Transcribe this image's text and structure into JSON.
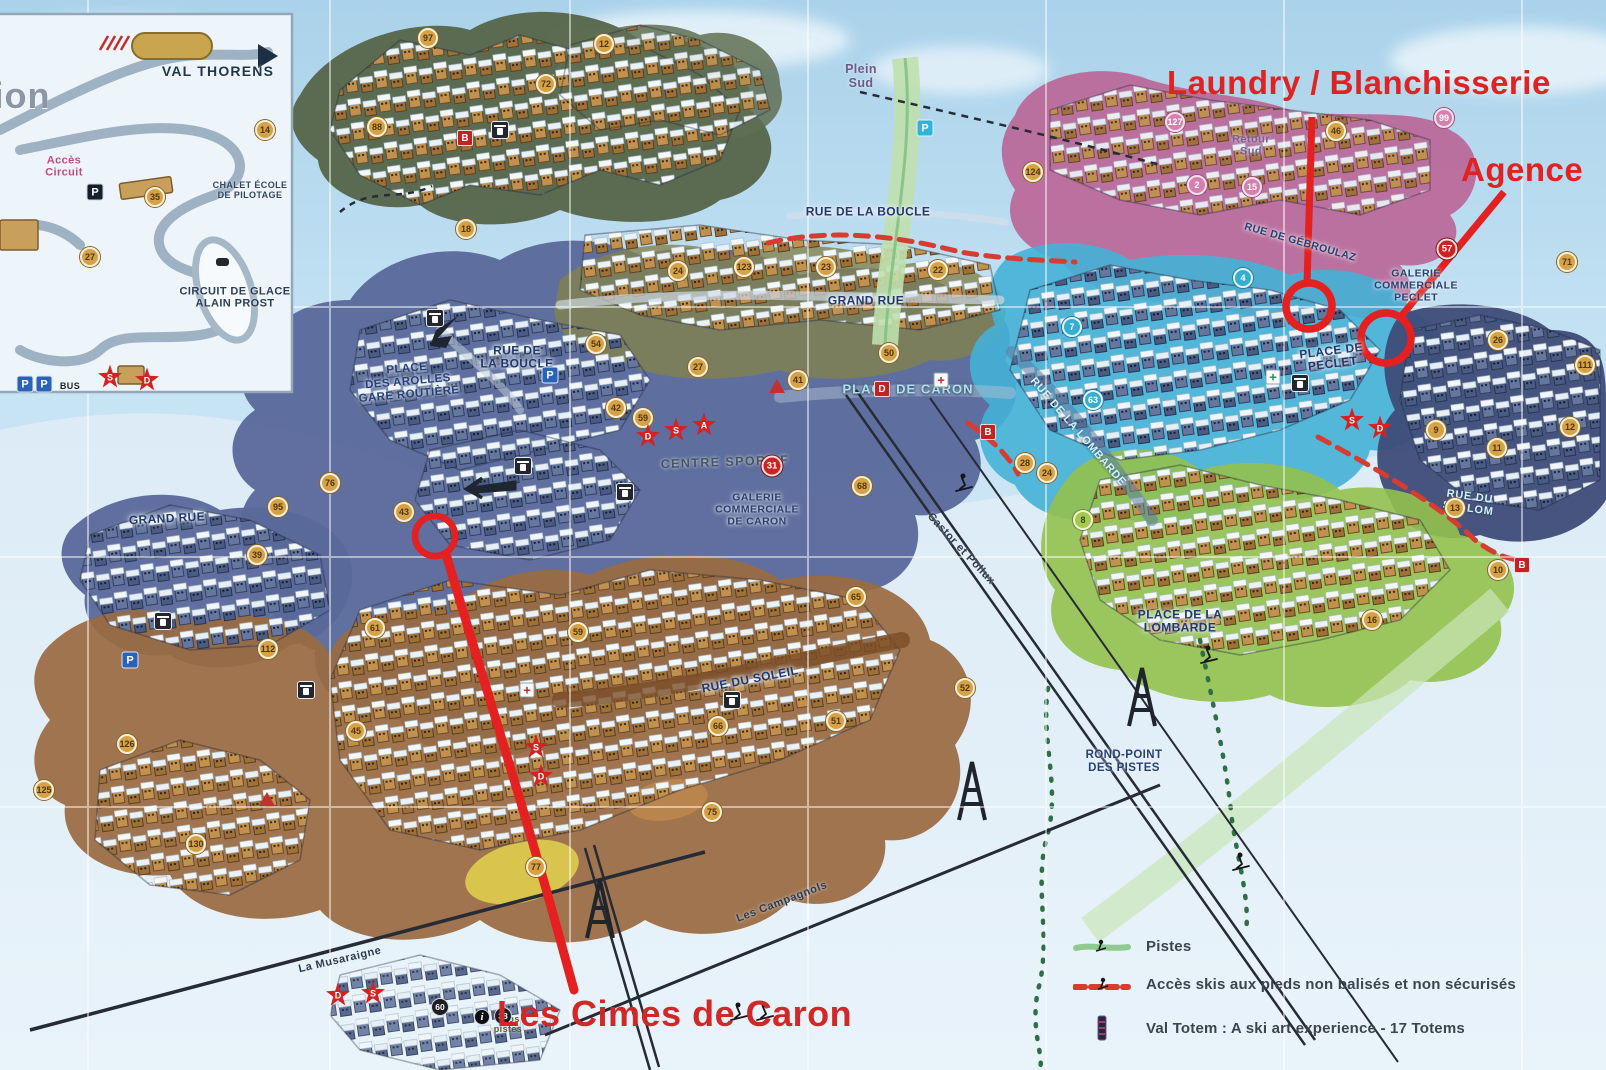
{
  "colors": {
    "annotation_red": "#e02222",
    "zone_pink": "#bb6798",
    "zone_cyan": "#45b1d6",
    "zone_lime": "#93c14c",
    "zone_slate": "#5a6a99",
    "zone_brown": "#9a6a41",
    "zone_olive": "#5f7050",
    "sky": "#bfe0f0"
  },
  "annotations": {
    "laundry": "Laundry / Blanchisserie",
    "agence": "Agence",
    "cimes": "Les Cimes de Caron"
  },
  "legend": {
    "items": [
      "Pistes",
      "Accès skis aux pieds non balisés et non sécurisés",
      "Val Totem : A ski art experience - 17 Totems"
    ]
  },
  "map": {
    "labels": [
      {
        "t": "ion",
        "x": 22,
        "y": 96,
        "c": "ghost",
        "r": 0
      },
      {
        "t": "VAL THORENS",
        "x": 218,
        "y": 72,
        "c": "inset-big",
        "r": 0
      },
      {
        "t": "Accès\nCircuit",
        "x": 64,
        "y": 167,
        "c": "pink-lbl",
        "r": 0
      },
      {
        "t": "CHALET ÉCOLE\nDE PILOTAGE",
        "x": 250,
        "y": 190,
        "c": "inset-sm",
        "r": 0
      },
      {
        "t": "CIRCUIT DE GLACE\nALAIN PROST",
        "x": 235,
        "y": 298,
        "c": "inset-md",
        "r": 0
      },
      {
        "t": "BUS",
        "x": 70,
        "y": 386,
        "c": "inset-xs",
        "r": 0
      },
      {
        "t": "Plein\nSud",
        "x": 861,
        "y": 76,
        "c": "purple",
        "r": 0
      },
      {
        "t": "Retour\nSud",
        "x": 1251,
        "y": 146,
        "c": "purple-sm",
        "r": 0
      },
      {
        "t": "RUE DE LA BOUCLE",
        "x": 868,
        "y": 212,
        "c": "street",
        "r": 0
      },
      {
        "t": "GRAND RUE",
        "x": 866,
        "y": 301,
        "c": "street",
        "r": 0
      },
      {
        "t": "RUE DE\nLA BOUCLE",
        "x": 517,
        "y": 358,
        "c": "street",
        "r": 0
      },
      {
        "t": "PLACE\nDES AROLLES\nGARE ROUTIÈRE",
        "x": 408,
        "y": 382,
        "c": "street-l",
        "r": -5
      },
      {
        "t": "GRAND RUE",
        "x": 167,
        "y": 519,
        "c": "street",
        "r": -3
      },
      {
        "t": "PLACE DE CARON",
        "x": 908,
        "y": 390,
        "c": "cyan-lbl",
        "r": 0
      },
      {
        "t": "CENTRE SPORTIF",
        "x": 725,
        "y": 462,
        "c": "grey-lbl",
        "r": -2
      },
      {
        "t": "GALERIE\nCOMMERCIALE\nDE CARON",
        "x": 757,
        "y": 510,
        "c": "street-sm",
        "r": 0
      },
      {
        "t": "RUE DU SOLEIL",
        "x": 750,
        "y": 680,
        "c": "street",
        "r": -11
      },
      {
        "t": "RUE DE LA LOMBARDE",
        "x": 1078,
        "y": 432,
        "c": "cyan-st",
        "r": 49
      },
      {
        "t": "PLACE DE LA\nLOMBARDE",
        "x": 1180,
        "y": 622,
        "c": "street",
        "r": 0
      },
      {
        "t": "ROND-POINT\nDES PISTES",
        "x": 1124,
        "y": 762,
        "c": "street-l",
        "r": 0
      },
      {
        "t": "GALERIE\nCOMMERCIALE\nPECLET",
        "x": 1416,
        "y": 286,
        "c": "street-sm",
        "r": 0
      },
      {
        "t": "PLACE DE\nPECLET",
        "x": 1332,
        "y": 358,
        "c": "street",
        "r": -7
      },
      {
        "t": "RUE DE GÉBROULAZ",
        "x": 1300,
        "y": 243,
        "c": "street-sm",
        "r": 16
      },
      {
        "t": "RUE DU\nSLALOM",
        "x": 1469,
        "y": 503,
        "c": "cyan-st",
        "r": 8
      },
      {
        "t": "Castor et Pollux",
        "x": 961,
        "y": 549,
        "c": "lift",
        "r": 47
      },
      {
        "t": "La Musaraigne",
        "x": 340,
        "y": 960,
        "c": "lift",
        "r": -13
      },
      {
        "t": "Les Campagnols",
        "x": 782,
        "y": 902,
        "c": "lift",
        "r": -21
      },
      {
        "t": "infos\npistes",
        "x": 508,
        "y": 1024,
        "c": "tan-xs",
        "r": 0
      }
    ],
    "markers": [
      {
        "t": "gold",
        "v": "97",
        "x": 428,
        "y": 38
      },
      {
        "t": "gold",
        "v": "72",
        "x": 546,
        "y": 84
      },
      {
        "t": "gold",
        "v": "12",
        "x": 604,
        "y": 44
      },
      {
        "t": "gold",
        "v": "88",
        "x": 377,
        "y": 127
      },
      {
        "t": "gold",
        "v": "18",
        "x": 466,
        "y": 229
      },
      {
        "t": "rsq",
        "v": "B",
        "x": 465,
        "y": 138
      },
      {
        "t": "gold",
        "v": "14",
        "x": 265,
        "y": 130
      },
      {
        "t": "gold",
        "v": "35",
        "x": 155,
        "y": 197
      },
      {
        "t": "gold",
        "v": "27",
        "x": 90,
        "y": 257
      },
      {
        "t": "star",
        "v": "S",
        "x": 110,
        "y": 377
      },
      {
        "t": "star",
        "v": "D",
        "x": 147,
        "y": 380
      },
      {
        "t": "pd",
        "v": "P",
        "x": 95,
        "y": 192
      },
      {
        "t": "p",
        "v": "P",
        "x": 25,
        "y": 384
      },
      {
        "t": "p",
        "v": "P",
        "x": 44,
        "y": 384
      },
      {
        "t": "pink",
        "v": "127",
        "x": 1175,
        "y": 122
      },
      {
        "t": "gold",
        "v": "124",
        "x": 1033,
        "y": 172
      },
      {
        "t": "pink",
        "v": "2",
        "x": 1197,
        "y": 185
      },
      {
        "t": "pink",
        "v": "15",
        "x": 1252,
        "y": 187
      },
      {
        "t": "pink",
        "v": "99",
        "x": 1444,
        "y": 118
      },
      {
        "t": "gold",
        "v": "46",
        "x": 1336,
        "y": 131
      },
      {
        "t": "red",
        "v": "57",
        "x": 1447,
        "y": 249
      },
      {
        "t": "gold",
        "v": "71",
        "x": 1567,
        "y": 262
      },
      {
        "t": "gold",
        "v": "123",
        "x": 744,
        "y": 267
      },
      {
        "t": "gold",
        "v": "23",
        "x": 826,
        "y": 267
      },
      {
        "t": "gold",
        "v": "22",
        "x": 938,
        "y": 270
      },
      {
        "t": "gold",
        "v": "24",
        "x": 678,
        "y": 271
      },
      {
        "t": "cyan",
        "v": "4",
        "x": 1243,
        "y": 278
      },
      {
        "t": "cyan",
        "v": "7",
        "x": 1072,
        "y": 327
      },
      {
        "t": "cyan",
        "v": "63",
        "x": 1093,
        "y": 400
      },
      {
        "t": "gold",
        "v": "54",
        "x": 596,
        "y": 344
      },
      {
        "t": "gold",
        "v": "27",
        "x": 698,
        "y": 367
      },
      {
        "t": "gold",
        "v": "50",
        "x": 889,
        "y": 353
      },
      {
        "t": "gold",
        "v": "41",
        "x": 798,
        "y": 380
      },
      {
        "t": "gold",
        "v": "42",
        "x": 616,
        "y": 408
      },
      {
        "t": "gold",
        "v": "59",
        "x": 643,
        "y": 418
      },
      {
        "t": "star",
        "v": "D",
        "x": 648,
        "y": 436
      },
      {
        "t": "star",
        "v": "S",
        "x": 676,
        "y": 430
      },
      {
        "t": "star",
        "v": "A",
        "x": 704,
        "y": 425
      },
      {
        "t": "rsq",
        "v": "D",
        "x": 882,
        "y": 389
      },
      {
        "t": "rsq",
        "v": "B",
        "x": 988,
        "y": 432
      },
      {
        "t": "tri",
        "v": "",
        "x": 777,
        "y": 386
      },
      {
        "t": "red",
        "v": "31",
        "x": 772,
        "y": 466
      },
      {
        "t": "crossR",
        "v": "+",
        "x": 941,
        "y": 380
      },
      {
        "t": "crossG",
        "v": "+",
        "x": 1273,
        "y": 377
      },
      {
        "t": "star",
        "v": "S",
        "x": 1352,
        "y": 420
      },
      {
        "t": "star",
        "v": "D",
        "x": 1380,
        "y": 428
      },
      {
        "t": "gold",
        "v": "26",
        "x": 1498,
        "y": 340
      },
      {
        "t": "gold",
        "v": "111",
        "x": 1585,
        "y": 365
      },
      {
        "t": "gold",
        "v": "9",
        "x": 1436,
        "y": 430
      },
      {
        "t": "gold",
        "v": "11",
        "x": 1497,
        "y": 448
      },
      {
        "t": "gold",
        "v": "12",
        "x": 1570,
        "y": 427
      },
      {
        "t": "gold",
        "v": "13",
        "x": 1455,
        "y": 508
      },
      {
        "t": "gold",
        "v": "10",
        "x": 1498,
        "y": 570
      },
      {
        "t": "rsq",
        "v": "B",
        "x": 1522,
        "y": 565
      },
      {
        "t": "gold",
        "v": "16",
        "x": 1372,
        "y": 620
      },
      {
        "t": "gold",
        "v": "28",
        "x": 1025,
        "y": 463
      },
      {
        "t": "gold",
        "v": "24",
        "x": 1047,
        "y": 473
      },
      {
        "t": "lime",
        "v": "8",
        "x": 1083,
        "y": 520
      },
      {
        "t": "gold",
        "v": "95",
        "x": 278,
        "y": 507
      },
      {
        "t": "gold",
        "v": "39",
        "x": 257,
        "y": 555
      },
      {
        "t": "gold",
        "v": "76",
        "x": 330,
        "y": 483
      },
      {
        "t": "gold",
        "v": "43",
        "x": 404,
        "y": 512
      },
      {
        "t": "gold",
        "v": "61",
        "x": 375,
        "y": 628
      },
      {
        "t": "gold",
        "v": "112",
        "x": 268,
        "y": 649
      },
      {
        "t": "gold",
        "v": "45",
        "x": 356,
        "y": 731
      },
      {
        "t": "gold",
        "v": "65",
        "x": 856,
        "y": 597
      },
      {
        "t": "gold",
        "v": "59",
        "x": 578,
        "y": 632
      },
      {
        "t": "gold",
        "v": "68",
        "x": 862,
        "y": 486
      },
      {
        "t": "gold",
        "v": "51",
        "x": 836,
        "y": 721
      },
      {
        "t": "gold",
        "v": "66",
        "x": 718,
        "y": 726
      },
      {
        "t": "gold",
        "v": "75",
        "x": 712,
        "y": 812
      },
      {
        "t": "gold",
        "v": "77",
        "x": 536,
        "y": 867
      },
      {
        "t": "gold",
        "v": "52",
        "x": 965,
        "y": 688
      },
      {
        "t": "star",
        "v": "S",
        "x": 536,
        "y": 747
      },
      {
        "t": "star",
        "v": "D",
        "x": 541,
        "y": 776
      },
      {
        "t": "tri",
        "v": "",
        "x": 267,
        "y": 799
      },
      {
        "t": "gold",
        "v": "126",
        "x": 127,
        "y": 744
      },
      {
        "t": "gold",
        "v": "125",
        "x": 44,
        "y": 790
      },
      {
        "t": "gold",
        "v": "130",
        "x": 196,
        "y": 844
      },
      {
        "t": "p",
        "v": "P",
        "x": 550,
        "y": 375
      },
      {
        "t": "p",
        "v": "P",
        "x": 130,
        "y": 660
      },
      {
        "t": "pc",
        "v": "P",
        "x": 925,
        "y": 128
      },
      {
        "t": "crossR",
        "v": "+",
        "x": 527,
        "y": 690
      },
      {
        "t": "dark",
        "v": "60",
        "x": 440,
        "y": 1007
      },
      {
        "t": "info",
        "v": "i",
        "x": 482,
        "y": 1017
      },
      {
        "t": "dark",
        "v": "38",
        "x": 503,
        "y": 1016
      },
      {
        "t": "star",
        "v": "D",
        "x": 338,
        "y": 995
      },
      {
        "t": "star",
        "v": "S",
        "x": 373,
        "y": 993
      },
      {
        "t": "lift",
        "v": "",
        "x": 500,
        "y": 130
      },
      {
        "t": "lift",
        "v": "",
        "x": 435,
        "y": 318
      },
      {
        "t": "lift",
        "v": "",
        "x": 523,
        "y": 466
      },
      {
        "t": "lift",
        "v": "",
        "x": 625,
        "y": 492
      },
      {
        "t": "lift",
        "v": "",
        "x": 732,
        "y": 700
      },
      {
        "t": "lift",
        "v": "",
        "x": 306,
        "y": 690
      },
      {
        "t": "lift",
        "v": "",
        "x": 163,
        "y": 621
      },
      {
        "t": "lift",
        "v": "",
        "x": 1300,
        "y": 383
      }
    ]
  }
}
